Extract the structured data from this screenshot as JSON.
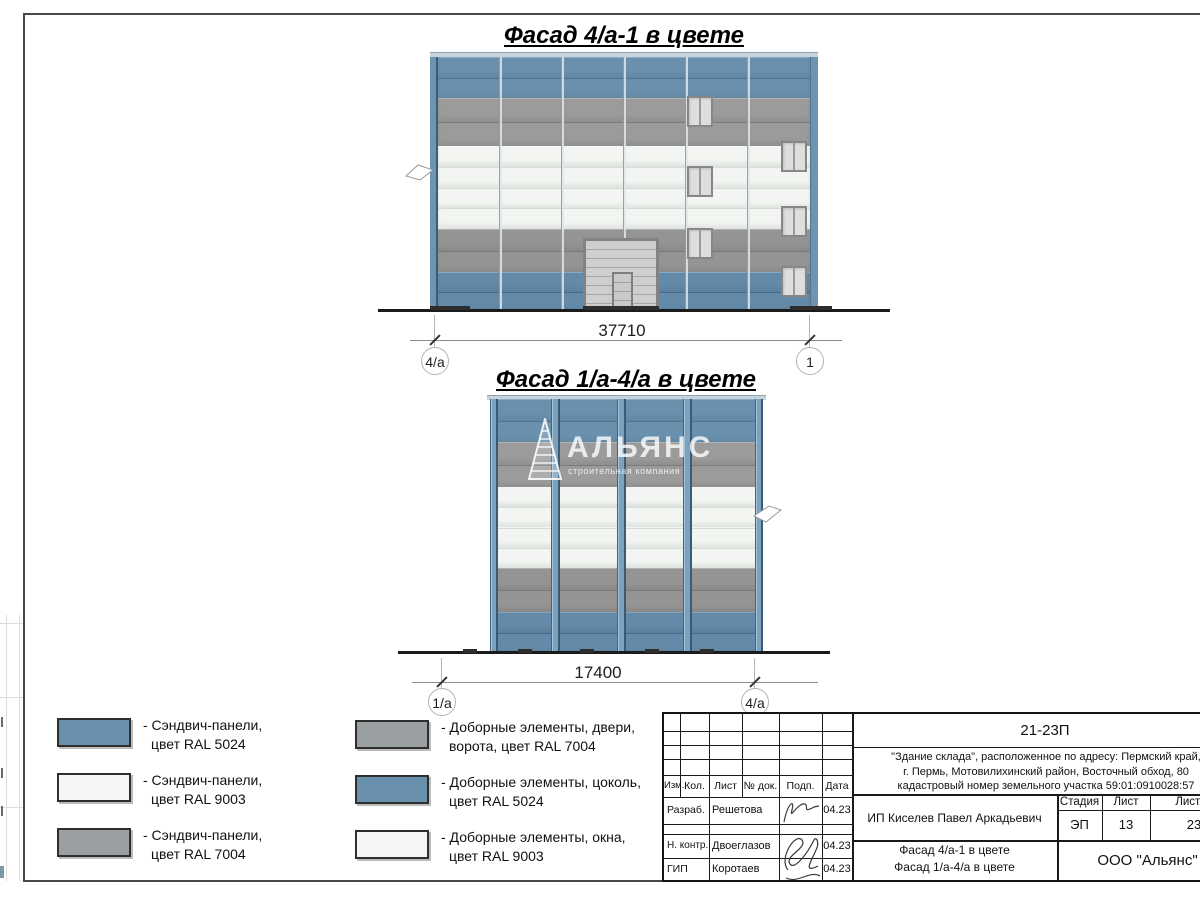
{
  "facade1": {
    "title": "Фасад 4/а-1 в цвете",
    "dimension": "37710",
    "axis_left": "4/а",
    "axis_right": "1"
  },
  "facade2": {
    "title": "Фасад 1/а-4/а в цвете",
    "dimension": "17400",
    "axis_left": "1/а",
    "axis_right": "4/а"
  },
  "watermark": {
    "name": "АЛЬЯНС",
    "subtitle": "строительная компания"
  },
  "colors": {
    "ral5024_blue": "#6991ae",
    "ral9003_white": "#f2f5f1",
    "ral7004_gray": "#9b9b9b"
  },
  "facade_specs": {
    "facade1": {
      "bands": [
        {
          "zone": "sandwich-panels RAL 5024",
          "color": "#6991ae",
          "sep": "#4d7298",
          "rows": 2,
          "h": 41
        },
        {
          "zone": "sandwich-panels RAL 7004",
          "color": "#9b9b9b",
          "sep": "#7b7b7b",
          "rows": 2,
          "h": 48
        },
        {
          "zone": "sandwich-panels RAL 9003",
          "color": "#f2f5f1",
          "sep": "#d6dbd6",
          "rows": 4,
          "h": 83
        },
        {
          "zone": "sandwich-panels RAL 7004",
          "color": "#949494",
          "sep": "#787878",
          "rows": 2,
          "h": 43
        },
        {
          "zone": "plinth RAL 5024",
          "color": "#638aa8",
          "sep": "#47698b",
          "rows": 2,
          "h": 39
        }
      ]
    },
    "facade2": {
      "bands": [
        {
          "zone": "sandwich-panels RAL 5024",
          "color": "#6991ae",
          "sep": "#4d7298",
          "rows": 2,
          "h": 43
        },
        {
          "zone": "sandwich-panels RAL 7004",
          "color": "#9b9b9b",
          "sep": "#7b7b7b",
          "rows": 2,
          "h": 45
        },
        {
          "zone": "sandwich-panels RAL 9003",
          "color": "#f2f5f1",
          "sep": "#d6dbd6",
          "rows": 4,
          "h": 81
        },
        {
          "zone": "sandwich-panels RAL 7004",
          "color": "#949494",
          "sep": "#787878",
          "rows": 2,
          "h": 44
        },
        {
          "zone": "plinth RAL 5024",
          "color": "#638aa8",
          "sep": "#47698b",
          "rows": 2,
          "h": 41
        }
      ]
    }
  },
  "legend": [
    {
      "color": "#6890ad",
      "line1": "- Сэндвич-панели,",
      "line2": "цвет RAL 5024"
    },
    {
      "color": "#f4f7f3",
      "line1": "- Сэндвич-панели,",
      "line2": "цвет RAL 9003"
    },
    {
      "color": "#9aa0a2",
      "line1": "- Сэндвич-панели,",
      "line2": "цвет RAL 7004"
    },
    {
      "color": "#9aa0a2",
      "line1": "- Доборные элементы, двери,",
      "line2": "ворота, цвет RAL 7004"
    },
    {
      "color": "#6890ad",
      "line1": "- Доборные элементы, цоколь,",
      "line2": "цвет RAL 5024"
    },
    {
      "color": "#f4f7f3",
      "line1": "- Доборные элементы, окна,",
      "line2": "цвет RAL 9003"
    }
  ],
  "title_block": {
    "doc_number": "21-23П",
    "project_line1": "\"Здание склада\", расположенное по адресу: Пермский край,",
    "project_line2": "г. Пермь, Мотовилихинский район, Восточный обход, 80",
    "project_line3": "кадастровый номер земельного участка 59:01:0910028:57",
    "rev_headers": [
      "Изм.",
      "Кол.",
      "Лист",
      "№ док.",
      "Подп.",
      "Дата"
    ],
    "roles": [
      {
        "role": "Разраб.",
        "name": "Решетова",
        "date": "04.23"
      },
      {
        "role": "Н. контр.",
        "name": "Двоеглазов",
        "date": "04.23"
      },
      {
        "role": "ГИП",
        "name": "Коротаев",
        "date": "04.23"
      }
    ],
    "client": "ИП Киселев Павел Аркадьевич",
    "sheet_title_line1": "Фасад 4/а-1 в цвете",
    "sheet_title_line2": "Фасад 1/а-4/а в цвете",
    "stage_label": "Стадия",
    "sheet_label": "Лист",
    "sheets_label": "Листов",
    "stage": "ЭП",
    "sheet": "13",
    "sheets": "23",
    "company": "ООО \"Альянс\""
  }
}
